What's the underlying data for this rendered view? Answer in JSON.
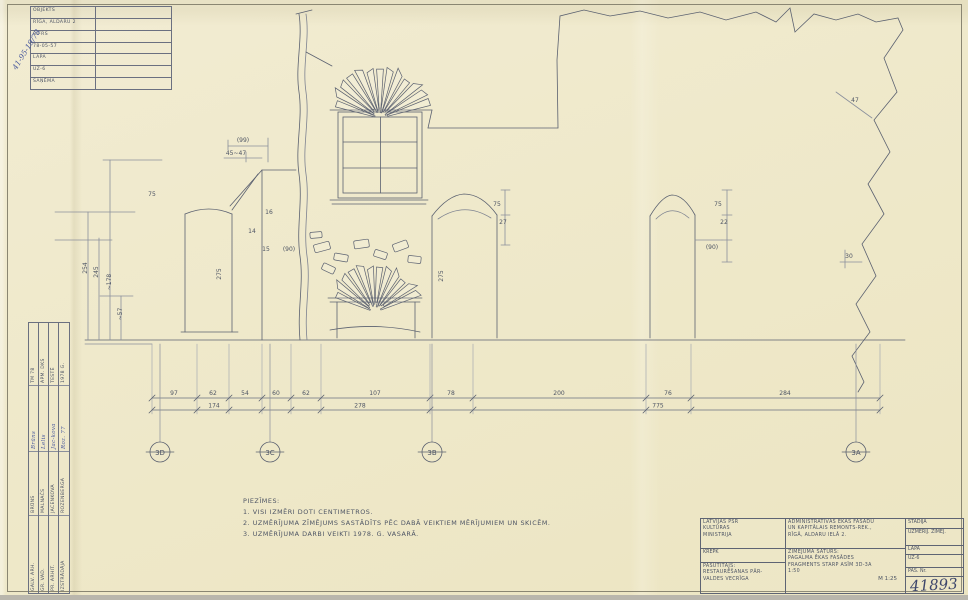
{
  "colors": {
    "paper": "#efe9cb",
    "ink": "#4d5464",
    "dim_line": "#707687",
    "blue_ink": "#4a5a9e",
    "frame": "#8a8672"
  },
  "corner_note": "41-95-19/78",
  "corner_stamp": {
    "rows": [
      {
        "label": "OBJEKTS"
      },
      {
        "label": "RĪGA, ALDARU 2"
      },
      {
        "label": "ŠIFRS"
      },
      {
        "label": "78-05-57"
      },
      {
        "label": "LAPA"
      },
      {
        "label": "UZ-6"
      },
      {
        "label": "SAŅĒMA"
      }
    ]
  },
  "signature_table": {
    "rows": [
      {
        "role": "GALV. ARH.",
        "name": "BRŪNS",
        "sig": "Brūns",
        "date": "TM 78"
      },
      {
        "role": "GR. VAD.",
        "name": "MALNAČS",
        "sig": "Lelis",
        "date": "APM. DKS"
      },
      {
        "role": "PR. ARHIT.",
        "name": "JACENKOVA",
        "sig": "Jac-kova",
        "date": "TESTĒ"
      },
      {
        "role": "IZSTRĀDĀJA",
        "name": "ROZENBERGA",
        "sig": "Roz. 77",
        "date": "1978 G."
      }
    ]
  },
  "notes": {
    "title": "PIEZĪMES:",
    "items": [
      "1. VISI IZMĒRI DOTI CENTIMETROS.",
      "2. UZMĒRĪJUMA ZĪMĒJUMS SASTĀDĪTS PĒC DABĀ VEIKTIEM MĒRĪJUMIEM UN SKICĒM.",
      "3. UZMĒRĪJUMA DARBI VEIKTI 1978. G. VASARĀ."
    ]
  },
  "drawing": {
    "axes": [
      {
        "label": "3D",
        "x": 160
      },
      {
        "label": "3C",
        "x": 270
      },
      {
        "label": "3B",
        "x": 432
      },
      {
        "label": "3A",
        "x": 856
      }
    ],
    "dim_chain": {
      "y": 398,
      "ticks": [
        152,
        197,
        229,
        262,
        291,
        321,
        430,
        473,
        646,
        691,
        880
      ],
      "labels": [
        {
          "t": "97",
          "x": 174
        },
        {
          "t": "62",
          "x": 213
        },
        {
          "t": "54",
          "x": 245
        },
        {
          "t": "60",
          "x": 276
        },
        {
          "t": "62",
          "x": 306
        },
        {
          "t": "107",
          "x": 375
        },
        {
          "t": "78",
          "x": 451
        },
        {
          "t": "200",
          "x": 559
        },
        {
          "t": "76",
          "x": 668
        },
        {
          "t": "284",
          "x": 785
        }
      ]
    },
    "dim_totals": {
      "y": 410,
      "labels": [
        {
          "t": "174",
          "x": 214
        },
        {
          "t": "278",
          "x": 360
        },
        {
          "t": "775",
          "x": 658
        }
      ]
    },
    "annotations": [
      {
        "t": "(99)",
        "x": 243,
        "y": 142,
        "r": 0
      },
      {
        "t": "45~47",
        "x": 236,
        "y": 155,
        "r": 0
      },
      {
        "t": "75",
        "x": 152,
        "y": 196,
        "r": 0
      },
      {
        "t": "254",
        "x": 87,
        "y": 268,
        "r": -90
      },
      {
        "t": "245",
        "x": 98,
        "y": 272,
        "r": -90
      },
      {
        "t": "~178",
        "x": 111,
        "y": 282,
        "r": -90
      },
      {
        "t": "~57",
        "x": 122,
        "y": 314,
        "r": -90
      },
      {
        "t": "275",
        "x": 221,
        "y": 274,
        "r": -90
      },
      {
        "t": "275",
        "x": 443,
        "y": 276,
        "r": -90
      },
      {
        "t": "16",
        "x": 269,
        "y": 214,
        "r": 0
      },
      {
        "t": "14",
        "x": 252,
        "y": 233,
        "r": 0
      },
      {
        "t": "15",
        "x": 266,
        "y": 251,
        "r": 0
      },
      {
        "t": "(90)",
        "x": 289,
        "y": 251,
        "r": 0
      },
      {
        "t": "75",
        "x": 497,
        "y": 206,
        "r": 0
      },
      {
        "t": "27",
        "x": 503,
        "y": 224,
        "r": 0
      },
      {
        "t": "75",
        "x": 718,
        "y": 206,
        "r": 0
      },
      {
        "t": "22",
        "x": 724,
        "y": 224,
        "r": 0
      },
      {
        "t": "(90)",
        "x": 712,
        "y": 249,
        "r": 0
      },
      {
        "t": "30",
        "x": 849,
        "y": 258,
        "r": 0
      },
      {
        "t": "47",
        "x": 855,
        "y": 102,
        "r": 0
      }
    ]
  },
  "title_block": {
    "org_lines": [
      "LATVIJAS PSR",
      "KULTŪRAS",
      "MINISTRIJA"
    ],
    "dept": "KREPK",
    "client_lines": [
      "PASŪTĪTĀJS:",
      "RESTAURĒŠANAS PĀR-",
      "VALDES VECRĪGA"
    ],
    "project_lines": [
      "ADMINISTRATĪVĀS ĒKAS FASĀDU",
      "UN KAPITĀLAIS REMONTS-REK.,",
      "RĪGĀ, ALDARU IELĀ 2."
    ],
    "content_label": "ZĪMĒJUMA SATURS:",
    "content_lines": [
      "PAGALMA ĒKAS FASĀDES",
      "FRAGMENTS STARP ASĪM 3D-3A",
      "1:50"
    ],
    "scale": "M 1:25",
    "stage_label": "STADIJA",
    "stage_value": "UZMĒRĪJ. ZĪMĒJ.",
    "sheet_label": "LAPA",
    "sheet_value": "UZ-6",
    "doc_label": "PAS. Nr.",
    "doc_number": "41893"
  }
}
